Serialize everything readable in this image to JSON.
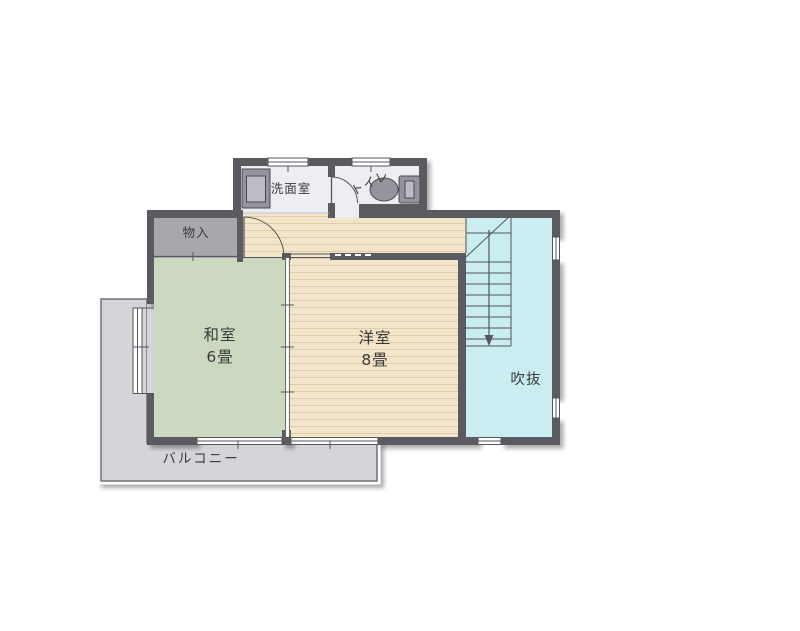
{
  "plan": {
    "type": "floor-plan",
    "floor_labels": {
      "washitsu": "和室",
      "washitsu_size": "6畳",
      "youshitsu": "洋室",
      "youshitsu_size": "8畳",
      "fukinuke": "吹抜",
      "monoire": "物入",
      "senmenshitsu": "洗面室",
      "toilet": "トイレ",
      "balcony": "バルコニー"
    }
  },
  "colors": {
    "wall": "#5a5a60",
    "wood_floor": "#f3e5c9",
    "wood_stripe": "#ddcda9",
    "tatami_green": "#ccd9c1",
    "atrium_cyan": "#c9edf0",
    "balcony_gray": "#d5d5d9",
    "closet_gray": "#a7a7ad",
    "washroom_floor": "#ededf4",
    "fixture_gray": "#94949d",
    "fixture_light": "#bcbcc4",
    "line": "#55555b",
    "text": "#3a3a3a",
    "white": "#ffffff"
  }
}
